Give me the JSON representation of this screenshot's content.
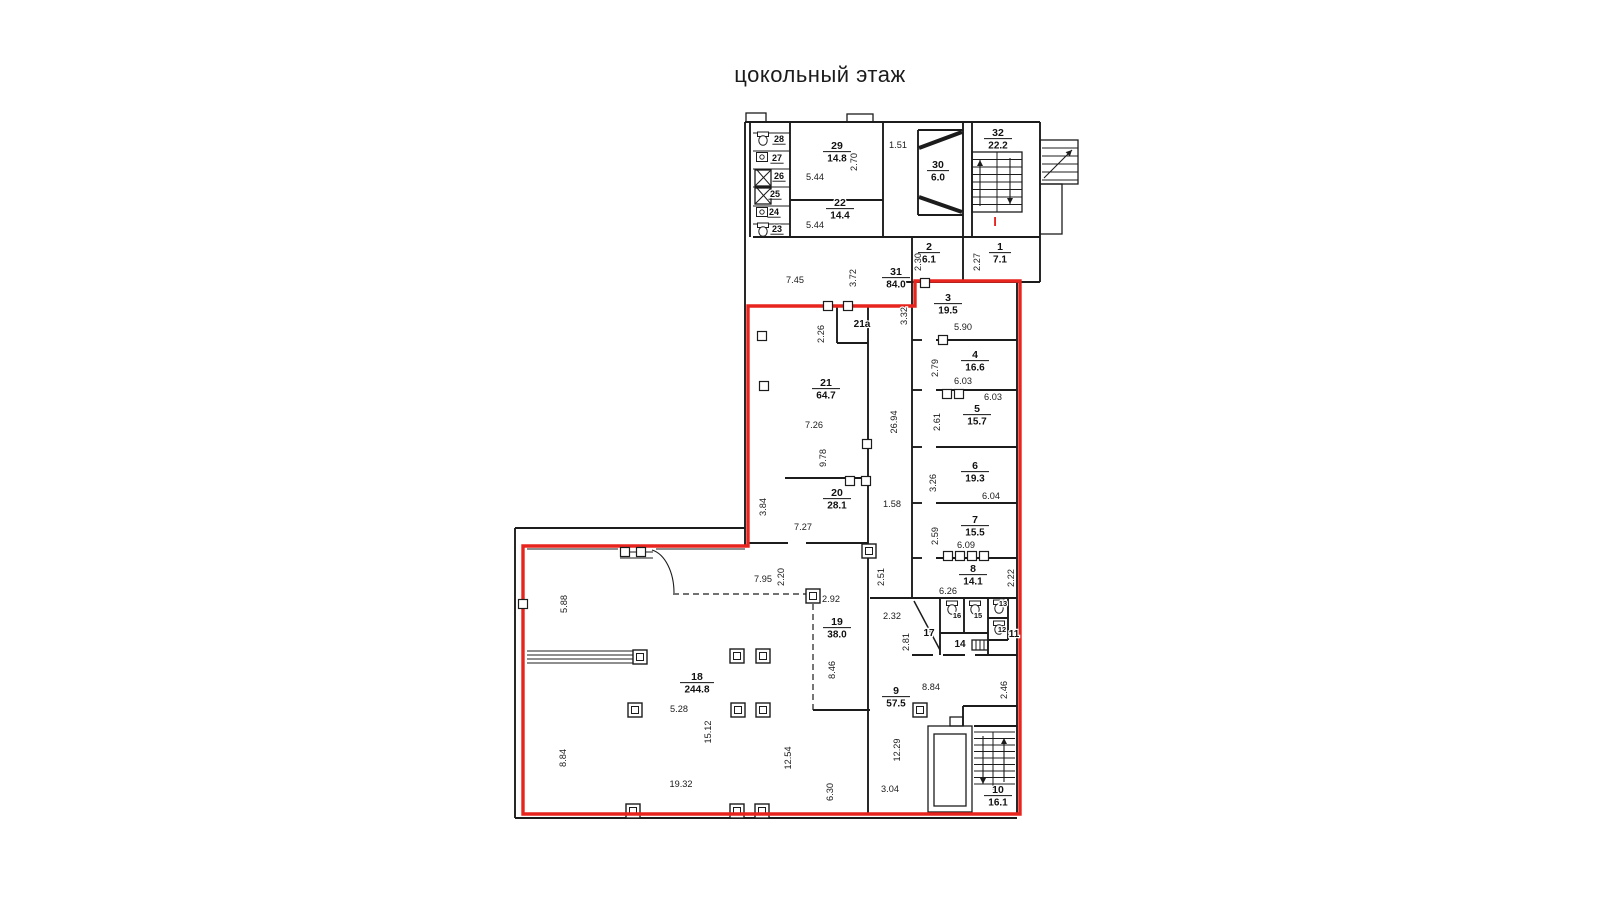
{
  "title": "цокольный этаж",
  "canvas": {
    "width": 1600,
    "height": 900,
    "background": "#ffffff"
  },
  "colors": {
    "wall": "#1c1c1c",
    "thin": "#2a2a2a",
    "dim_text": "#1b1b1b",
    "red_outline": "#e8241f",
    "label": "#111111"
  },
  "plan": {
    "red_path": "M748,306 L915,306 L915,281 L1020,281 L1020,814 L523,814 L523,546 L748,546 Z",
    "red_mark": {
      "text": "I",
      "x": 995,
      "y": 226
    },
    "walls": [
      [
        745,
        122,
        1040,
        122
      ],
      [
        745,
        122,
        745,
        546
      ],
      [
        750,
        122,
        750,
        237
      ],
      [
        1040,
        122,
        1040,
        282
      ],
      [
        1017,
        282,
        1040,
        282
      ],
      [
        1017,
        282,
        1017,
        815
      ],
      [
        515,
        528,
        515,
        818
      ],
      [
        515,
        528,
        745,
        528
      ],
      [
        515,
        818,
        1017,
        818
      ],
      [
        753,
        237,
        1040,
        237
      ],
      [
        790,
        122,
        790,
        237
      ],
      [
        883,
        122,
        883,
        237
      ],
      [
        790,
        200,
        883,
        200
      ],
      [
        918,
        130,
        963,
        130
      ],
      [
        918,
        130,
        918,
        215
      ],
      [
        918,
        215,
        963,
        215
      ],
      [
        963,
        122,
        963,
        237
      ],
      [
        972,
        122,
        972,
        237
      ],
      [
        912,
        237,
        912,
        282
      ],
      [
        963,
        237,
        963,
        282
      ],
      [
        905,
        282,
        1040,
        282
      ],
      [
        912,
        282,
        912,
        598
      ],
      [
        912,
        340,
        922,
        340
      ],
      [
        936,
        340,
        1017,
        340
      ],
      [
        912,
        390,
        922,
        390
      ],
      [
        936,
        390,
        1017,
        390
      ],
      [
        912,
        447,
        922,
        447
      ],
      [
        936,
        447,
        1017,
        447
      ],
      [
        912,
        503,
        922,
        503
      ],
      [
        936,
        503,
        1017,
        503
      ],
      [
        912,
        558,
        922,
        558
      ],
      [
        936,
        558,
        1017,
        558
      ],
      [
        870,
        598,
        1017,
        598
      ],
      [
        868,
        306,
        868,
        815
      ],
      [
        748,
        306,
        868,
        306
      ],
      [
        837,
        306,
        837,
        343
      ],
      [
        837,
        343,
        868,
        343
      ],
      [
        785,
        478,
        868,
        478
      ],
      [
        748,
        543,
        788,
        543
      ],
      [
        806,
        543,
        868,
        543
      ],
      [
        912,
        655,
        933,
        655
      ],
      [
        943,
        655,
        965,
        655
      ],
      [
        975,
        655,
        1017,
        655
      ],
      [
        940,
        598,
        940,
        655
      ],
      [
        940,
        633,
        988,
        633
      ],
      [
        964,
        598,
        964,
        633
      ],
      [
        988,
        598,
        988,
        655
      ],
      [
        988,
        618,
        1008,
        618
      ],
      [
        988,
        640,
        1008,
        640
      ],
      [
        1008,
        598,
        1008,
        640
      ],
      [
        813,
        710,
        870,
        710
      ],
      [
        963,
        706,
        1017,
        706
      ],
      [
        963,
        706,
        963,
        726
      ],
      [
        974,
        726,
        1017,
        726
      ]
    ],
    "thin_walls": [
      [
        753,
        133,
        790,
        133
      ],
      [
        753,
        151,
        790,
        151
      ],
      [
        753,
        169,
        790,
        169
      ],
      [
        753,
        187,
        790,
        187
      ],
      [
        753,
        206,
        790,
        206
      ],
      [
        753,
        224,
        790,
        224
      ],
      [
        527,
        549,
        618,
        549
      ],
      [
        656,
        549,
        745,
        549
      ],
      [
        620,
        552,
        653,
        552
      ],
      [
        620,
        558,
        653,
        558
      ],
      [
        527,
        651,
        637,
        651
      ],
      [
        527,
        655,
        637,
        655
      ],
      [
        527,
        659,
        637,
        659
      ],
      [
        527,
        663,
        637,
        663
      ],
      [
        997,
        152,
        997,
        212
      ],
      [
        993,
        732,
        993,
        790
      ],
      [
        976,
        640,
        976,
        650
      ],
      [
        980,
        640,
        980,
        650
      ],
      [
        984,
        640,
        984,
        650
      ]
    ],
    "dashed_walls": [
      [
        673,
        594,
        813,
        594
      ],
      [
        813,
        594,
        813,
        710
      ]
    ],
    "rects": [
      [
        972,
        152,
        50,
        60
      ],
      [
        928,
        726,
        44,
        86
      ],
      [
        934,
        734,
        32,
        72
      ],
      [
        746,
        113,
        20,
        9
      ],
      [
        847,
        114,
        26,
        8
      ],
      [
        1040,
        140,
        38,
        44
      ],
      [
        1040,
        184,
        22,
        50
      ],
      [
        950,
        717,
        13,
        9
      ],
      [
        972,
        640,
        16,
        10
      ],
      [
        755,
        170,
        16,
        16
      ],
      [
        755,
        188,
        16,
        16
      ]
    ],
    "stair_runs": [
      {
        "x": 972,
        "w": 50,
        "y0": 152,
        "y1": 212,
        "step": 7.5
      },
      {
        "x": 974,
        "w": 41,
        "y0": 732,
        "y1": 790,
        "step": 6.5
      },
      {
        "x": 1042,
        "w": 36,
        "y0": 148,
        "y1": 180,
        "step": 8
      }
    ],
    "arrows": [
      {
        "x1": 980,
        "y1": 206,
        "x2": 980,
        "y2": 160
      },
      {
        "x1": 1010,
        "y1": 158,
        "x2": 1010,
        "y2": 204
      },
      {
        "x1": 983,
        "y1": 736,
        "x2": 983,
        "y2": 784
      },
      {
        "x1": 1004,
        "y1": 782,
        "x2": 1004,
        "y2": 738
      },
      {
        "x1": 1044,
        "y1": 178,
        "x2": 1072,
        "y2": 150
      }
    ],
    "diagonals": [
      {
        "l": [
          919,
          148,
          962,
          132
        ],
        "w": 4
      },
      {
        "l": [
          919,
          197,
          962,
          212
        ],
        "w": 4
      },
      {
        "l": [
          914,
          601,
          940,
          650
        ],
        "w": 1.5
      },
      {
        "l": [
          757,
          170,
          771,
          186
        ],
        "w": 1
      },
      {
        "l": [
          755,
          186,
          771,
          170
        ],
        "w": 1
      },
      {
        "l": [
          757,
          188,
          771,
          204
        ],
        "w": 1
      },
      {
        "l": [
          755,
          204,
          771,
          188
        ],
        "w": 1
      }
    ],
    "arcs": [
      "M652,550 C 665,554 674,572 674,593"
    ],
    "columns": [
      [
        737,
        656
      ],
      [
        763,
        656
      ],
      [
        635,
        710
      ],
      [
        738,
        710
      ],
      [
        763,
        710
      ],
      [
        633,
        811
      ],
      [
        737,
        811
      ],
      [
        762,
        811
      ],
      [
        920,
        710
      ],
      [
        640,
        657
      ],
      [
        869,
        551
      ],
      [
        813,
        596
      ]
    ],
    "wall_boxes": [
      [
        828,
        306
      ],
      [
        848,
        306
      ],
      [
        762,
        336
      ],
      [
        764,
        386
      ],
      [
        867,
        444
      ],
      [
        850,
        481
      ],
      [
        866,
        481
      ],
      [
        943,
        340
      ],
      [
        947,
        394
      ],
      [
        959,
        394
      ],
      [
        948,
        556
      ],
      [
        960,
        556
      ],
      [
        972,
        556
      ],
      [
        984,
        556
      ],
      [
        625,
        552
      ],
      [
        641,
        552
      ],
      [
        523,
        604
      ],
      [
        925,
        283
      ]
    ],
    "toilets": [
      {
        "x": 952,
        "y": 608
      },
      {
        "x": 975,
        "y": 608
      },
      {
        "x": 999,
        "y": 607
      },
      {
        "x": 999,
        "y": 628
      },
      {
        "x": 763,
        "y": 139
      },
      {
        "x": 763,
        "y": 230
      }
    ],
    "sinks": [
      {
        "x": 762,
        "y": 157
      },
      {
        "x": 762,
        "y": 212
      }
    ],
    "rooms": [
      {
        "n": "1",
        "a": "7.1",
        "x": 1000,
        "y": 250
      },
      {
        "n": "2",
        "a": "6.1",
        "x": 929,
        "y": 250
      },
      {
        "n": "3",
        "a": "19.5",
        "x": 948,
        "y": 301
      },
      {
        "n": "4",
        "a": "16.6",
        "x": 975,
        "y": 358
      },
      {
        "n": "5",
        "a": "15.7",
        "x": 977,
        "y": 412
      },
      {
        "n": "6",
        "a": "19.3",
        "x": 975,
        "y": 469
      },
      {
        "n": "7",
        "a": "15.5",
        "x": 975,
        "y": 523
      },
      {
        "n": "8",
        "a": "14.1",
        "x": 973,
        "y": 572
      },
      {
        "n": "9",
        "a": "57.5",
        "x": 896,
        "y": 694
      },
      {
        "n": "10",
        "a": "16.1",
        "x": 998,
        "y": 793
      },
      {
        "n": "18",
        "a": "244.8",
        "x": 697,
        "y": 680
      },
      {
        "n": "19",
        "a": "38.0",
        "x": 837,
        "y": 625
      },
      {
        "n": "20",
        "a": "28.1",
        "x": 837,
        "y": 496
      },
      {
        "n": "21",
        "a": "64.7",
        "x": 826,
        "y": 386
      },
      {
        "n": "22",
        "a": "14.4",
        "x": 840,
        "y": 206
      },
      {
        "n": "29",
        "a": "14.8",
        "x": 837,
        "y": 149
      },
      {
        "n": "30",
        "a": "6.0",
        "x": 938,
        "y": 168
      },
      {
        "n": "31",
        "a": "84.0",
        "x": 896,
        "y": 275
      },
      {
        "n": "32",
        "a": "22.2",
        "x": 998,
        "y": 136
      }
    ],
    "labels": [
      {
        "t": "21a",
        "x": 862,
        "y": 327,
        "s": 10,
        "u": false
      },
      {
        "t": "17",
        "x": 929,
        "y": 636,
        "s": 10,
        "u": false
      },
      {
        "t": "14",
        "x": 960,
        "y": 647,
        "s": 10,
        "u": false
      },
      {
        "t": "11",
        "x": 1014,
        "y": 637,
        "s": 10,
        "u": false
      },
      {
        "t": "16",
        "x": 957,
        "y": 618,
        "s": 7.5,
        "u": false
      },
      {
        "t": "15",
        "x": 978,
        "y": 618,
        "s": 7.5,
        "u": false
      },
      {
        "t": "13",
        "x": 1003,
        "y": 606,
        "s": 7.5,
        "u": false
      },
      {
        "t": "12",
        "x": 1002,
        "y": 632,
        "s": 7.5,
        "u": false
      },
      {
        "t": "28",
        "x": 779,
        "y": 142,
        "s": 9,
        "u": true
      },
      {
        "t": "27",
        "x": 777,
        "y": 161,
        "s": 9,
        "u": true
      },
      {
        "t": "26",
        "x": 779,
        "y": 179,
        "s": 9,
        "u": true
      },
      {
        "t": "25",
        "x": 775,
        "y": 197,
        "s": 9,
        "u": true
      },
      {
        "t": "24",
        "x": 774,
        "y": 215,
        "s": 9,
        "u": true
      },
      {
        "t": "23",
        "x": 777,
        "y": 232,
        "s": 9,
        "u": true
      }
    ],
    "dims": [
      {
        "t": "5.44",
        "x": 815,
        "y": 180,
        "r": 0
      },
      {
        "t": "2.70",
        "x": 857,
        "y": 162,
        "r": 1
      },
      {
        "t": "5.44",
        "x": 815,
        "y": 228,
        "r": 0
      },
      {
        "t": "1.51",
        "x": 898,
        "y": 148,
        "r": 0
      },
      {
        "t": "7.45",
        "x": 795,
        "y": 283,
        "r": 0
      },
      {
        "t": "3.72",
        "x": 856,
        "y": 278,
        "r": 1
      },
      {
        "t": "2.30",
        "x": 921,
        "y": 262,
        "r": 1
      },
      {
        "t": "2.27",
        "x": 980,
        "y": 262,
        "r": 1
      },
      {
        "t": "5.90",
        "x": 963,
        "y": 330,
        "r": 0
      },
      {
        "t": "3.32",
        "x": 907,
        "y": 316,
        "r": 1
      },
      {
        "t": "2.79",
        "x": 938,
        "y": 368,
        "r": 1
      },
      {
        "t": "6.03",
        "x": 963,
        "y": 384,
        "r": 0
      },
      {
        "t": "2.61",
        "x": 940,
        "y": 422,
        "r": 1
      },
      {
        "t": "6.03",
        "x": 993,
        "y": 400,
        "r": 0
      },
      {
        "t": "3.26",
        "x": 936,
        "y": 483,
        "r": 1
      },
      {
        "t": "6.04",
        "x": 991,
        "y": 499,
        "r": 0
      },
      {
        "t": "2.59",
        "x": 938,
        "y": 536,
        "r": 1
      },
      {
        "t": "6.09",
        "x": 966,
        "y": 548,
        "r": 0
      },
      {
        "t": "2.22",
        "x": 1014,
        "y": 578,
        "r": 1
      },
      {
        "t": "6.26",
        "x": 948,
        "y": 594,
        "r": 0
      },
      {
        "t": "26.94",
        "x": 897,
        "y": 422,
        "r": 1
      },
      {
        "t": "1.58",
        "x": 892,
        "y": 507,
        "r": 0
      },
      {
        "t": "2.26",
        "x": 824,
        "y": 334,
        "r": 1
      },
      {
        "t": "7.26",
        "x": 814,
        "y": 428,
        "r": 0
      },
      {
        "t": "9.78",
        "x": 826,
        "y": 458,
        "r": 1
      },
      {
        "t": "3.84",
        "x": 766,
        "y": 507,
        "r": 1
      },
      {
        "t": "7.27",
        "x": 803,
        "y": 530,
        "r": 0
      },
      {
        "t": "5.88",
        "x": 567,
        "y": 604,
        "r": 1
      },
      {
        "t": "7.95",
        "x": 763,
        "y": 582,
        "r": 0
      },
      {
        "t": "2.20",
        "x": 784,
        "y": 577,
        "r": 1
      },
      {
        "t": "2.92",
        "x": 831,
        "y": 602,
        "r": 0
      },
      {
        "t": "2.51",
        "x": 884,
        "y": 577,
        "r": 1
      },
      {
        "t": "2.32",
        "x": 892,
        "y": 619,
        "r": 0
      },
      {
        "t": "2.81",
        "x": 909,
        "y": 642,
        "r": 1
      },
      {
        "t": "8.46",
        "x": 835,
        "y": 670,
        "r": 1
      },
      {
        "t": "5.28",
        "x": 679,
        "y": 712,
        "r": 0
      },
      {
        "t": "15.12",
        "x": 711,
        "y": 732,
        "r": 1
      },
      {
        "t": "8.84",
        "x": 566,
        "y": 758,
        "r": 1
      },
      {
        "t": "12.54",
        "x": 791,
        "y": 758,
        "r": 1
      },
      {
        "t": "19.32",
        "x": 681,
        "y": 787,
        "r": 0
      },
      {
        "t": "6.30",
        "x": 833,
        "y": 792,
        "r": 1
      },
      {
        "t": "3.04",
        "x": 890,
        "y": 792,
        "r": 0
      },
      {
        "t": "12.29",
        "x": 900,
        "y": 750,
        "r": 1
      },
      {
        "t": "8.84",
        "x": 931,
        "y": 690,
        "r": 0
      },
      {
        "t": "2.46",
        "x": 1007,
        "y": 690,
        "r": 1
      }
    ]
  }
}
